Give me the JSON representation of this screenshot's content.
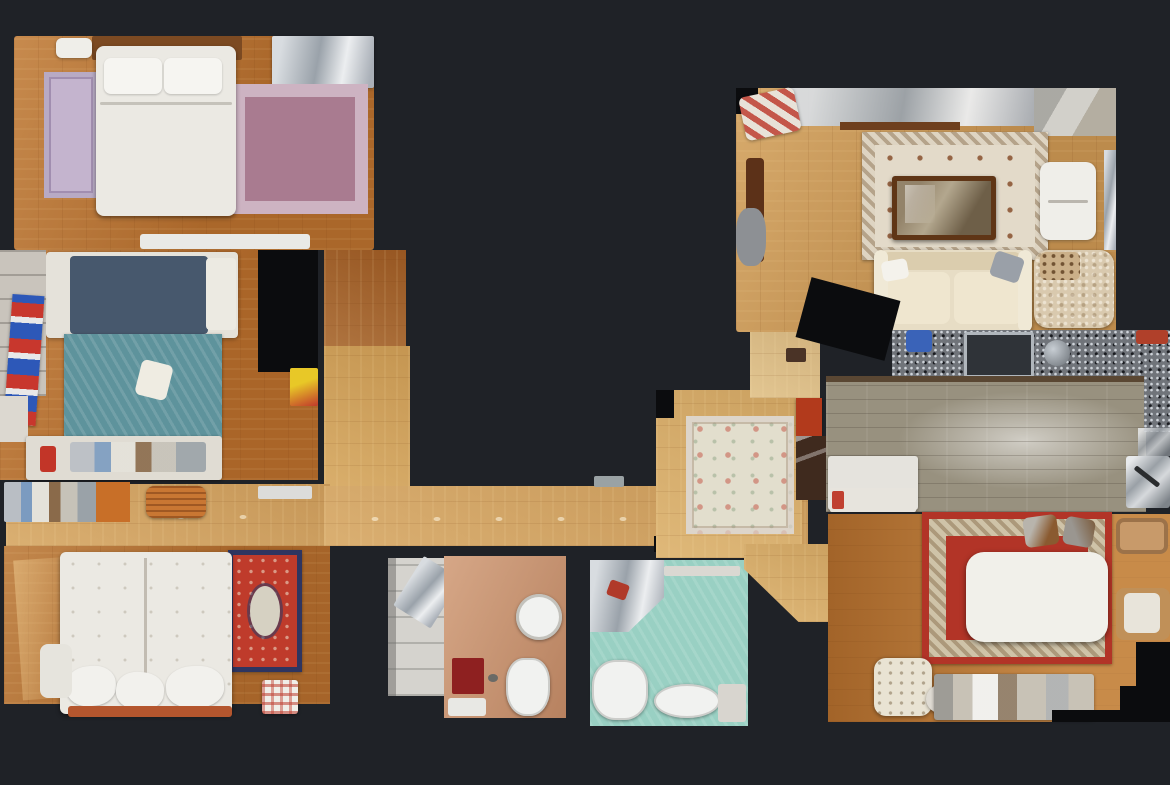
{
  "scene": {
    "background": "#1f2227",
    "wall_color": "#0b0c0e"
  },
  "rooms": {
    "bedroom1": {
      "name": "bedroom-top-left",
      "floor_color": "#b9712f"
    },
    "bedroom2": {
      "name": "bedroom-middle-left",
      "floor_color": "#b96f2d"
    },
    "bedroom3": {
      "name": "bedroom-bottom-left",
      "floor_color": "#b46e2e"
    },
    "hallway": {
      "name": "central-hallway",
      "floor_color": "#d3a25f"
    },
    "foyer": {
      "name": "foyer",
      "floor_color": "#d9ad68"
    },
    "bathroom1": {
      "name": "bathroom-center",
      "floor_color": "#c8906c"
    },
    "bathroom2": {
      "name": "bathroom-teal",
      "floor_color": "#99d0c3"
    },
    "living": {
      "name": "living-room",
      "floor_color": "#cd9955"
    },
    "kitchen": {
      "name": "kitchen",
      "floor_color": "#98917f"
    },
    "dining": {
      "name": "dining-room",
      "floor_color": "#b06c2c"
    }
  },
  "palette": {
    "granite": "#70747a",
    "kitchen_edge": "#5a4733",
    "rug_lavender": "#c4b4ce",
    "rug_mauve": "#a97b90",
    "rug_teal": "#5e939c",
    "rug_oriental_red": "#bf3b2b",
    "rug_oriental_border": "#2e3560",
    "rug_cream": "#ded4c2",
    "rug_cream_field": "#e3dac9",
    "rug_floral": "#e2decd",
    "rug_dining_red": "#b23427",
    "rug_dining_border": "#cfc3a8",
    "bed_white": "#ebe9e3",
    "mattress_navy": "#47586d",
    "sofa_cream": "#e7ddc5",
    "dining_table_white": "#f1f0ea",
    "coffee_table_brown": "#5f3516",
    "fixture_white": "#f1f2f0",
    "bath_mat_red": "#8e2020",
    "cabinet_red": "#b23a1c",
    "pouf_orange": "#c97733",
    "wood_corridor_dark": "#a05c24",
    "wood_corridor_light": "#d2a158"
  }
}
